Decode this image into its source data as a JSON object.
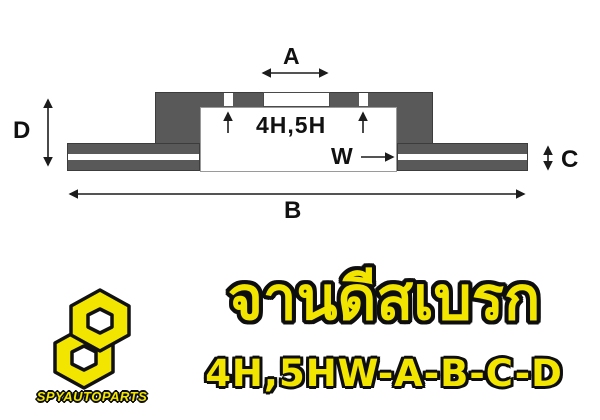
{
  "diagram": {
    "label_a": "A",
    "label_b": "B",
    "label_c": "C",
    "label_d": "D",
    "label_w": "W",
    "label_holes": "4H,5H",
    "fill_color": "#595959"
  },
  "banner": {
    "brand": "SPYAUTOPARTS",
    "title_thai": "จานดีสเบรก",
    "subtitle": "4H,5HW-A-B-C-D",
    "text_color": "#f2e600",
    "outline_color": "#0e0e0e"
  }
}
